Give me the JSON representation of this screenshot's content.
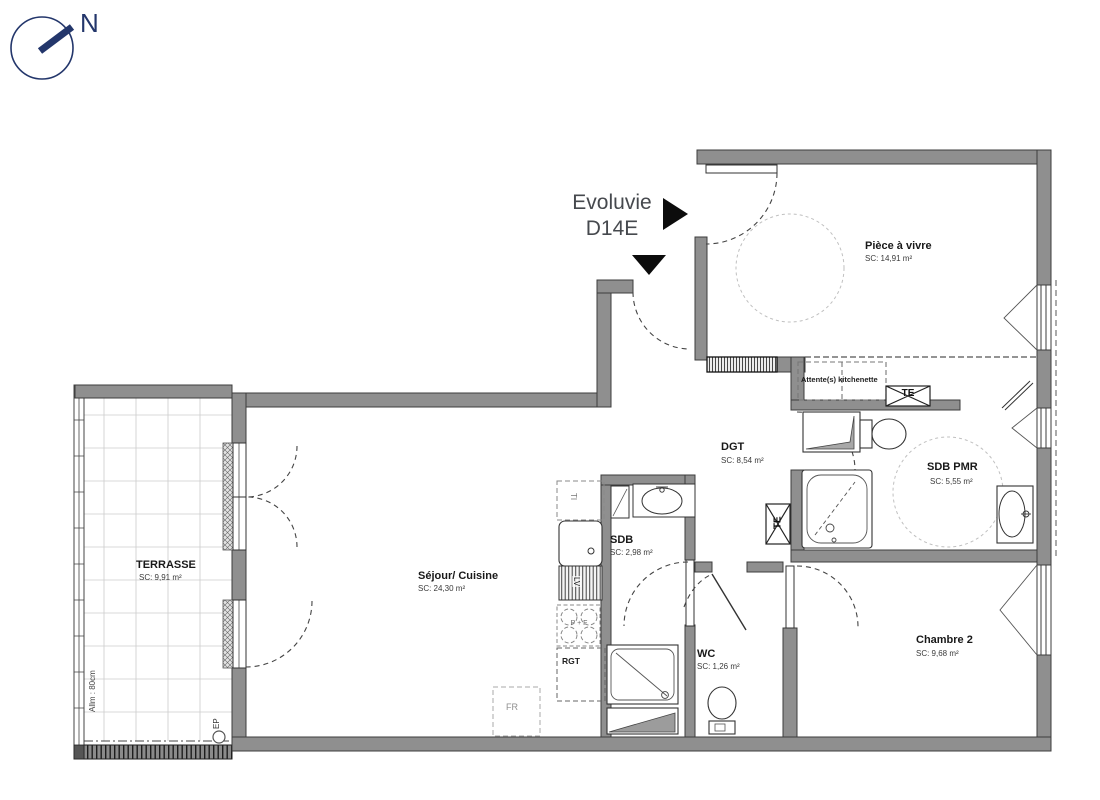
{
  "meta": {
    "plan_name": "Evoluvie",
    "unit": "D14E"
  },
  "compass": {
    "label": "N"
  },
  "title": {
    "line1": "Evoluvie",
    "line2": "D14E"
  },
  "rooms": [
    {
      "name": "Pièce à vivre",
      "area": "SC: 14,91 m²"
    },
    {
      "name": "DGT",
      "area": "SC: 8,54 m²"
    },
    {
      "name": "SDB PMR",
      "area": "SC: 5,55 m²"
    },
    {
      "name": "SDB",
      "area": "SC: 2,98 m²"
    },
    {
      "name": "Séjour/ Cuisine",
      "area": "SC: 24,30 m²"
    },
    {
      "name": "WC",
      "area": "SC: 1,26 m²"
    },
    {
      "name": "Chambre 2",
      "area": "SC: 9,68 m²"
    },
    {
      "name": "TERRASSE",
      "area": "SC: 9,91 m²"
    }
  ],
  "annotations": {
    "kitchenette": "Attente(s) kitchenette",
    "te1": "TE",
    "te2": "TE",
    "rgt": "RGT",
    "fr": "FR",
    "ti": "TI",
    "lv": "LV",
    "cooktop": "P + F",
    "allege": "Allm : 80cm",
    "ep": "EP"
  },
  "colors": {
    "wall_fill": "#8f8f8f",
    "wall_outline": "#3c3c3c",
    "compass_navy": "#23366b",
    "title_text": "#46494e",
    "label_text": "#191919",
    "dashed_light": "#c0c0c0"
  }
}
